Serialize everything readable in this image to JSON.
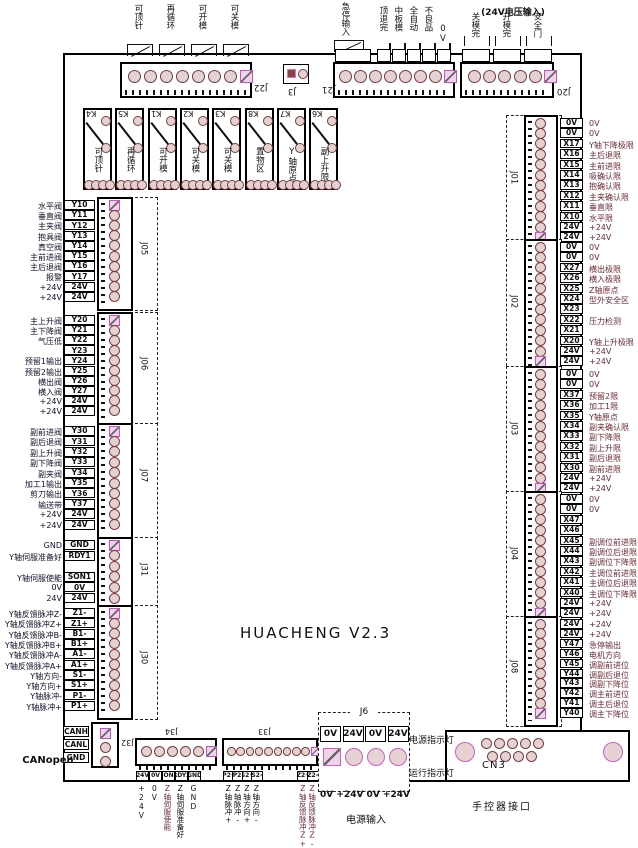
{
  "board": {
    "title": "HUACHENG   V2.3"
  },
  "top": {
    "relay_coils": [
      "可顶针",
      "再循环",
      "可开模",
      "可关模"
    ],
    "j22": {
      "name": "J22"
    },
    "j3": {
      "name": "J3"
    },
    "j21": {
      "name": "J21",
      "signals": [
        "急停输入",
        "顶退完",
        "中板模",
        "全自动",
        "不良品",
        "0V"
      ]
    },
    "j20": {
      "name": "J20",
      "title": "(24V电压输入)",
      "signals": [
        "关模完",
        "开模完",
        "安全门"
      ]
    }
  },
  "relays": [
    {
      "id": "K4",
      "label": "可顶针"
    },
    {
      "id": "K5",
      "label": "再循环"
    },
    {
      "id": "K1",
      "label": "可开模"
    },
    {
      "id": "K2",
      "label": "可关模"
    },
    {
      "id": "K3",
      "label": "可关模"
    },
    {
      "id": "K8",
      "label": "置物区"
    },
    {
      "id": "K7",
      "label": "Y轴原点"
    },
    {
      "id": "K6",
      "label": "副上升限"
    }
  ],
  "left_connectors": [
    {
      "name": "J05",
      "rows": [
        {
          "label": "水平阀",
          "pin": "Y10"
        },
        {
          "label": "垂直阀",
          "pin": "Y11"
        },
        {
          "label": "主夹阀",
          "pin": "Y12"
        },
        {
          "label": "抱具阀",
          "pin": "Y13"
        },
        {
          "label": "真空阀",
          "pin": "Y14"
        },
        {
          "label": "主前进阀",
          "pin": "Y15"
        },
        {
          "label": "主后退阀",
          "pin": "Y16"
        },
        {
          "label": "报警",
          "pin": "Y17"
        },
        {
          "label": "+24V",
          "pin": "24V"
        },
        {
          "label": "+24V",
          "pin": "24V"
        }
      ]
    },
    {
      "name": "J06",
      "rows": [
        {
          "label": "主上升阀",
          "pin": "Y20"
        },
        {
          "label": "主下降阀",
          "pin": "Y21"
        },
        {
          "label": "气压低",
          "pin": "Y22"
        },
        {
          "label": "",
          "pin": "Y23"
        },
        {
          "label": "预留1输出",
          "pin": "Y24"
        },
        {
          "label": "预留2输出",
          "pin": "Y25"
        },
        {
          "label": "横出阀",
          "pin": "Y26"
        },
        {
          "label": "横入阀",
          "pin": "Y27"
        },
        {
          "label": "+24V",
          "pin": "24V"
        },
        {
          "label": "+24V",
          "pin": "24V"
        }
      ]
    },
    {
      "name": "J07",
      "rows": [
        {
          "label": "副前进阀",
          "pin": "Y30"
        },
        {
          "label": "副后退阀",
          "pin": "Y31"
        },
        {
          "label": "副上升阀",
          "pin": "Y32"
        },
        {
          "label": "副下降阀",
          "pin": "Y33"
        },
        {
          "label": "副夹阀",
          "pin": "Y34"
        },
        {
          "label": "加工1输出",
          "pin": "Y35"
        },
        {
          "label": "剪刀输出",
          "pin": "Y36"
        },
        {
          "label": "输送带",
          "pin": "Y37"
        },
        {
          "label": "+24V",
          "pin": "24V"
        },
        {
          "label": "+24V",
          "pin": "24V"
        }
      ]
    },
    {
      "name": "J31",
      "rows": [
        {
          "label": "GND",
          "pin": "GND"
        },
        {
          "label": "Y轴伺服准备好",
          "pin": "RDY1"
        },
        {
          "label": "",
          "pin": ""
        },
        {
          "label": "Y轴伺服使能",
          "pin": "SON1"
        },
        {
          "label": "0V",
          "pin": "0V"
        },
        {
          "label": "24V",
          "pin": "24V"
        }
      ]
    },
    {
      "name": "J30",
      "rows": [
        {
          "label": "Y轴反馈脉冲Z-",
          "pin": "Z1-"
        },
        {
          "label": "Y轴反馈脉冲Z+",
          "pin": "Z1+"
        },
        {
          "label": "Y轴反馈脉冲B-",
          "pin": "B1-"
        },
        {
          "label": "Y轴反馈脉冲B+",
          "pin": "B1+"
        },
        {
          "label": "Y轴反馈脉冲A-",
          "pin": "A1-"
        },
        {
          "label": "Y轴反馈脉冲A+",
          "pin": "A1+"
        },
        {
          "label": "Y轴方向-",
          "pin": "S1-"
        },
        {
          "label": "Y轴方向+",
          "pin": "S1+"
        },
        {
          "label": "Y轴脉冲-",
          "pin": "P1-"
        },
        {
          "label": "Y轴脉冲+",
          "pin": "P1+"
        }
      ]
    }
  ],
  "right_connectors": [
    {
      "name": "J01",
      "rows": [
        {
          "pin": "0V",
          "label": "0V"
        },
        {
          "pin": "0V",
          "label": "0V"
        },
        {
          "pin": "X17",
          "label": "Y轴下降极限"
        },
        {
          "pin": "X16",
          "label": "主后退限"
        },
        {
          "pin": "X15",
          "label": "主前进限"
        },
        {
          "pin": "X14",
          "label": "吸确认限"
        },
        {
          "pin": "X13",
          "label": "抱确认限"
        },
        {
          "pin": "X12",
          "label": "主夹确认限"
        },
        {
          "pin": "X11",
          "label": "垂直限"
        },
        {
          "pin": "X10",
          "label": "水平限"
        },
        {
          "pin": "24V",
          "label": "+24V"
        },
        {
          "pin": "24V",
          "label": "+24V"
        }
      ]
    },
    {
      "name": "J02",
      "rows": [
        {
          "pin": "0V",
          "label": "0V"
        },
        {
          "pin": "0V",
          "label": "0V"
        },
        {
          "pin": "X27",
          "label": "横出极限"
        },
        {
          "pin": "X26",
          "label": "横入极限"
        },
        {
          "pin": "X25",
          "label": "Z轴原点"
        },
        {
          "pin": "X24",
          "label": "型外安全区"
        },
        {
          "pin": "X23",
          "label": ""
        },
        {
          "pin": "X22",
          "label": "压力检测"
        },
        {
          "pin": "X21",
          "label": ""
        },
        {
          "pin": "X20",
          "label": "Y轴上升极限"
        },
        {
          "pin": "24V",
          "label": "+24V"
        },
        {
          "pin": "24V",
          "label": "+24V"
        }
      ]
    },
    {
      "name": "J03",
      "rows": [
        {
          "pin": "0V",
          "label": "0V"
        },
        {
          "pin": "0V",
          "label": "0V"
        },
        {
          "pin": "X37",
          "label": "预留2限"
        },
        {
          "pin": "X36",
          "label": "加工1限"
        },
        {
          "pin": "X35",
          "label": "Y轴原点"
        },
        {
          "pin": "X34",
          "label": "副夹确认限"
        },
        {
          "pin": "X33",
          "label": "副下降限"
        },
        {
          "pin": "X32",
          "label": "副上升限"
        },
        {
          "pin": "X31",
          "label": "副后退限"
        },
        {
          "pin": "X30",
          "label": "副前进限"
        },
        {
          "pin": "24V",
          "label": "+24V"
        },
        {
          "pin": "24V",
          "label": "+24V"
        }
      ]
    },
    {
      "name": "J04",
      "rows": [
        {
          "pin": "0V",
          "label": "0V"
        },
        {
          "pin": "0V",
          "label": "0V"
        },
        {
          "pin": "X47",
          "label": ""
        },
        {
          "pin": "X46",
          "label": ""
        },
        {
          "pin": "X45",
          "label": "副调位前进限"
        },
        {
          "pin": "X44",
          "label": "副调位后退限"
        },
        {
          "pin": "X43",
          "label": "副调位下降限"
        },
        {
          "pin": "X42",
          "label": "主调位前进限"
        },
        {
          "pin": "X41",
          "label": "主调位后退限"
        },
        {
          "pin": "X40",
          "label": "主调位下降限"
        },
        {
          "pin": "24V",
          "label": "+24V"
        },
        {
          "pin": "24V",
          "label": "+24V"
        }
      ]
    },
    {
      "name": "J08",
      "rows": [
        {
          "pin": "24V",
          "label": "+24V"
        },
        {
          "pin": "24V",
          "label": "+24V"
        },
        {
          "pin": "Y47",
          "label": "急停输出"
        },
        {
          "pin": "Y46",
          "label": "电机方向"
        },
        {
          "pin": "Y45",
          "label": "调副前进位"
        },
        {
          "pin": "Y44",
          "label": "调副后退位"
        },
        {
          "pin": "Y43",
          "label": "调副下降位"
        },
        {
          "pin": "Y42",
          "label": "调主前进位"
        },
        {
          "pin": "Y41",
          "label": "调主后退位"
        },
        {
          "pin": "Y40",
          "label": "调主下降位"
        }
      ]
    }
  ],
  "bottom": {
    "canopen": {
      "label": "CANopen",
      "name": "J32",
      "pins": [
        "CANH",
        "CANL",
        "GND"
      ]
    },
    "j34": {
      "name": "J34",
      "pins": [
        "24V",
        "0V",
        "SON2",
        "RDY2",
        "GND"
      ],
      "signals": [
        "+24V",
        "0V",
        "Z轴伺服使能",
        "Z轴伺服准备好",
        "GND"
      ]
    },
    "j33": {
      "name": "J33",
      "pins": [
        "P2+",
        "P2-",
        "S2+",
        "S2-",
        "Z2+",
        "Z2-"
      ],
      "signals": [
        "Z轴脉冲+",
        "Z轴脉冲-",
        "Z轴方向+",
        "Z轴方向-",
        "Z轴反馈脉冲Z+",
        "Z轴反馈脉冲Z-"
      ]
    },
    "j6": {
      "name": "J6",
      "pins": [
        "0V",
        "24V",
        "0V",
        "24V"
      ],
      "below": "0V  +24V  0V  +24V",
      "caption": "电源输入"
    },
    "indicators": [
      "电源指示灯",
      "运行指示灯"
    ],
    "cn3": {
      "name": "CN3",
      "caption": "手控器接口"
    }
  },
  "colors": {
    "pad_ring": "#7c3a3a",
    "pin1_ring": "#c753c0",
    "label_red": "#6d2b35"
  }
}
